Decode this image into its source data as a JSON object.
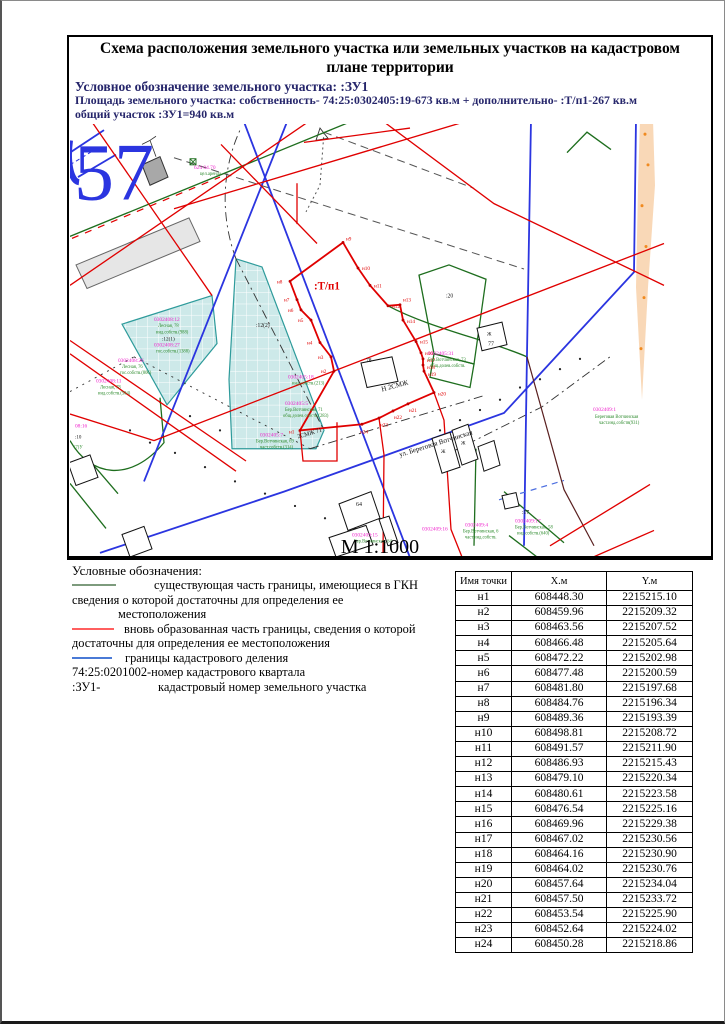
{
  "header": {
    "title": "Схема расположения земельного участка или земельных участков на кадастровом плане территории",
    "designation_line": "Условное обозначение земельного участка: :ЗУ1",
    "area_line": "Площадь земельного участка: собственность- 74:25:0302405:19-673 кв.м + дополнительно- :Т/п1-267 кв.м",
    "total_line": "общий участок :ЗУ1=940 кв.м"
  },
  "map": {
    "big_number": "57",
    "scale": "М 1:1000",
    "plot_label": ":Т/п1",
    "street_label": "ул. Береговая Вотчинская",
    "point_names": [
      "н1",
      "н2",
      "н3",
      "н4",
      "н5",
      "н6",
      "н7",
      "н8",
      "н9",
      "н10",
      "н11",
      "н12",
      "н13",
      "н14",
      "н15",
      "н16",
      "н17",
      "н18",
      "н19",
      "н20",
      "н21",
      "н22",
      "н23",
      "н24"
    ],
    "labels": {
      "l_624": "624 04.70",
      "l_624_sub": "цел.аренда",
      "p0302408_12": "0302408:12",
      "p0302408_12_sub1": "Лесная, 78",
      "p0302408_12_sub2": "инд.собств.(988)",
      "p12_1": ":12(1)",
      "p0302408_27": "0302408:27",
      "p0302408_27_sub": "гос.собств.(1388)",
      "p0302408_26": "0302408:26",
      "p0302408_26_sub1": "Лесная, 76",
      "p0302408_26_sub2": "гос.собств.(806)",
      "p0302408_11": "0302408:11",
      "p0302408_11_sub1": "Лесная, 78",
      "p0302408_11_sub2": "инд.собств.(504)",
      "p08_16": "08:16",
      "p_10": ":10",
      "p_7u": "(7)У",
      "p12_2": ":12(2)",
      "p_20": ":20",
      "p0302405_18": "0302405:18",
      "p0302405_18_sub": "инд.собств.(213)",
      "p0302405_5": "0302405:5",
      "p0302405_5_sub1": "Бер.Вотчинская, 71",
      "p0302405_5_sub2": "общ.долев.собств.(283)",
      "p0302405_7": "0302405:7",
      "p0302405_7_sub1": "Бер.Вотчинская, 69",
      "p0302405_7_sub2": "част.собств.(314)",
      "p0302405_31": "0302405:31",
      "p0302405_31_sub1": "Бер.Вотчинская, 73",
      "p0302405_31_sub2": "общ.долев.собств.",
      "p0302409_15": "0302409:15",
      "p0302409_15_sub": "Бер.Вотчинская, 64",
      "p0302409_16": "0302409:16",
      "p0302409_4": "0302409:4",
      "p0302409_4_sub1": "Бер.Вотчинская, 6",
      "p0302409_4_sub2": "част.инд.собств.",
      "p_17": ":17",
      "p0302409_17": "0302409:17",
      "p0302409_17_sub1": "Бер.Вотчинская, 58",
      "p0302409_17_sub2": "инд.собств.(640)",
      "p0302409_1": "0302409:1",
      "p0302409_1_sub1": "Береговая Вотчинская",
      "p0302409_1_sub2": "част.инд.собств(931)",
      "b77": "77",
      "b78": "78",
      "b64": "64",
      "zh": "Ж",
      "zone1": "Н 2СМЖ",
      "zone2": "2СМЖ 71"
    }
  },
  "legend": {
    "heading": "Условные обозначения:",
    "item1_l1": "существующая часть границы, имеющиеся в ГКН",
    "item1_l2": "сведения о которой достаточны для определения ее",
    "item1_l3": "местоположения",
    "item2_l1": "вновь образованная часть границы, сведения о которой",
    "item2_l2": "достаточны для определения ее местоположения",
    "item3": "границы кадастрового деления",
    "quarter_line": "74:25:0201002-номер кадастрового квартала",
    "plot_prefix": ":ЗУ1-",
    "plot_text": "кадастровый номер земельного участка"
  },
  "table": {
    "headers": [
      "Имя точки",
      "X.м",
      "Y.м"
    ],
    "rows": [
      [
        "н1",
        "608448.30",
        "2215215.10"
      ],
      [
        "н2",
        "608459.96",
        "2215209.32"
      ],
      [
        "н3",
        "608463.56",
        "2215207.52"
      ],
      [
        "н4",
        "608466.48",
        "2215205.64"
      ],
      [
        "н5",
        "608472.22",
        "2215202.98"
      ],
      [
        "н6",
        "608477.48",
        "2215200.59"
      ],
      [
        "н7",
        "608481.80",
        "2215197.68"
      ],
      [
        "н8",
        "608484.76",
        "2215196.34"
      ],
      [
        "н9",
        "608489.36",
        "2215193.39"
      ],
      [
        "н10",
        "608498.81",
        "2215208.72"
      ],
      [
        "н11",
        "608491.57",
        "2215211.90"
      ],
      [
        "н12",
        "608486.93",
        "2215215.43"
      ],
      [
        "н13",
        "608479.10",
        "2215220.34"
      ],
      [
        "н14",
        "608480.61",
        "2215223.58"
      ],
      [
        "н15",
        "608476.54",
        "2215225.16"
      ],
      [
        "н16",
        "608469.96",
        "2215229.38"
      ],
      [
        "н17",
        "608467.02",
        "2215230.56"
      ],
      [
        "н18",
        "608464.16",
        "2215230.90"
      ],
      [
        "н19",
        "608464.02",
        "2215230.76"
      ],
      [
        "н20",
        "608457.64",
        "2215234.04"
      ],
      [
        "н21",
        "608457.50",
        "2215233.72"
      ],
      [
        "н22",
        "608453.54",
        "2215225.90"
      ],
      [
        "н23",
        "608452.64",
        "2215224.02"
      ],
      [
        "н24",
        "608450.28",
        "2215218.86"
      ]
    ]
  },
  "colors": {
    "existing_boundary": "#7d9b7d",
    "new_boundary": "#e00000",
    "cadastral_division": "#2b35e0",
    "parcel_number": "#ee22cc",
    "big_number": "#2b35e0"
  }
}
